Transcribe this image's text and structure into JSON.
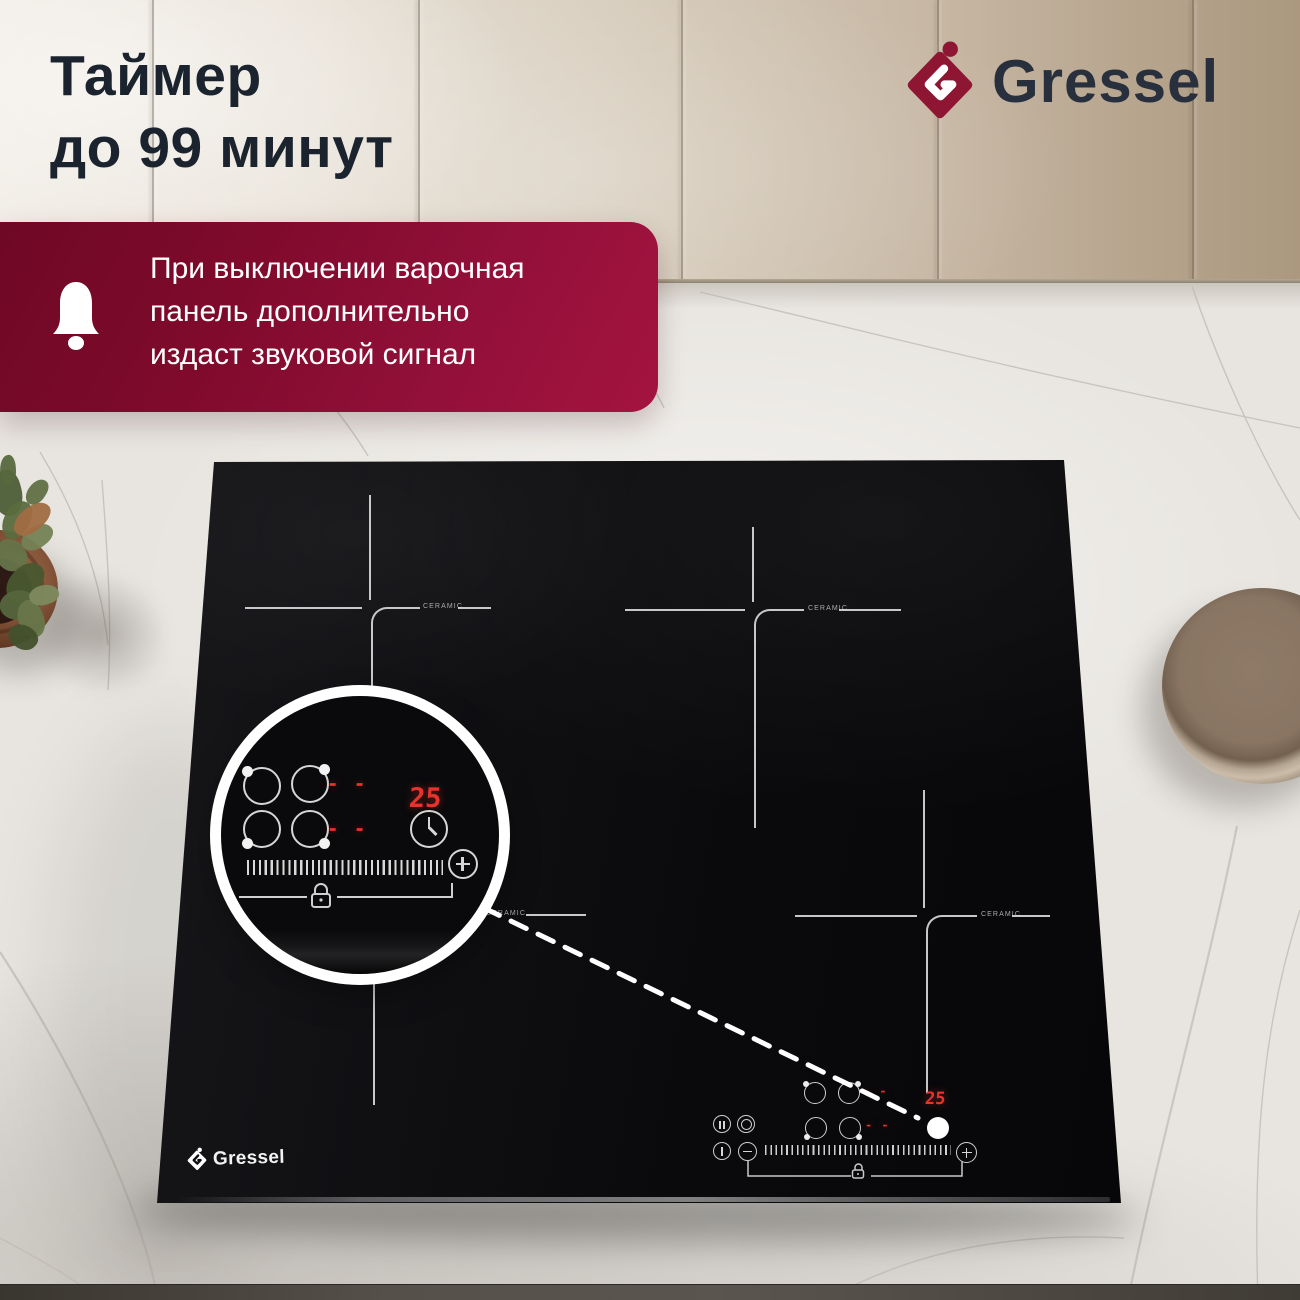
{
  "headline": {
    "line1": "Таймер",
    "line2": "до 99 минут"
  },
  "brand": {
    "name": "Gressel",
    "accent_color": "#8e1632",
    "text_color": "#27303c"
  },
  "banner": {
    "line1": "При выключении варочная",
    "line2": "панель дополнительно",
    "line3": "издаст звуковой сигнал",
    "background_color": "#8e0c33"
  },
  "cooktop": {
    "surface_label": "CERAMIC",
    "timer_value": "25",
    "standby_display": "- -",
    "display_color": "#e5342c",
    "icons": [
      "pause-icon",
      "dual-zone-icon",
      "power-icon",
      "minus-icon",
      "plus-icon",
      "lock-icon",
      "clock-icon",
      "burner-select-icon"
    ]
  }
}
